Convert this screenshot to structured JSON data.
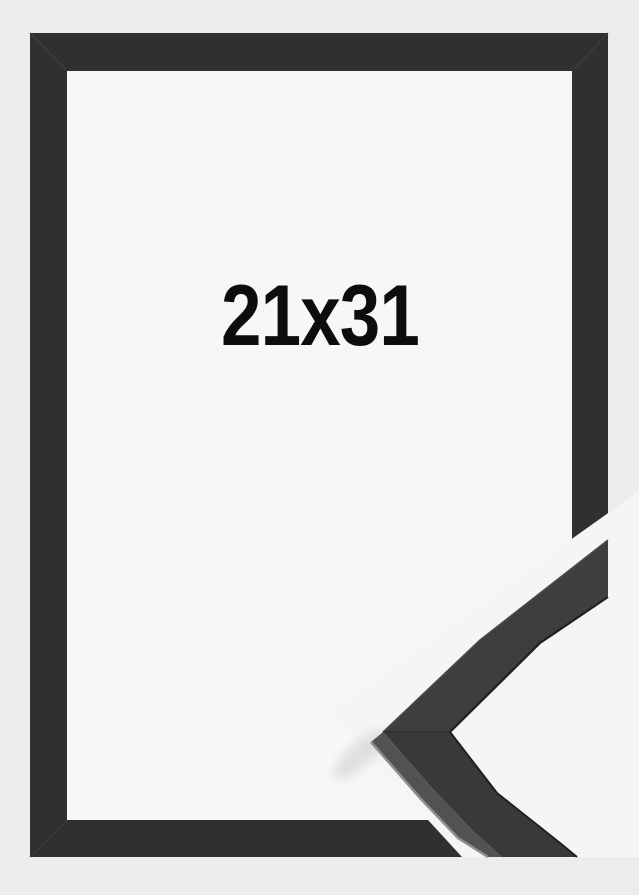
{
  "product": {
    "size_label": "21x31",
    "colors": {
      "background": "#ececec",
      "mat": "#f7f7f7",
      "frame": "#303033",
      "frame_seam": "#3c3c40",
      "detail_background": "#f5f5f5",
      "detail_arm_top": "#3e3e41",
      "detail_arm_top_edge": "#4a4a4e",
      "detail_arm_bottom": "#39393c",
      "detail_arm_side": "#525255",
      "detail_edge_dark": "#202023",
      "detail_edge_highlight": "#8e8e91",
      "label_color": "#0d0d0d"
    }
  }
}
